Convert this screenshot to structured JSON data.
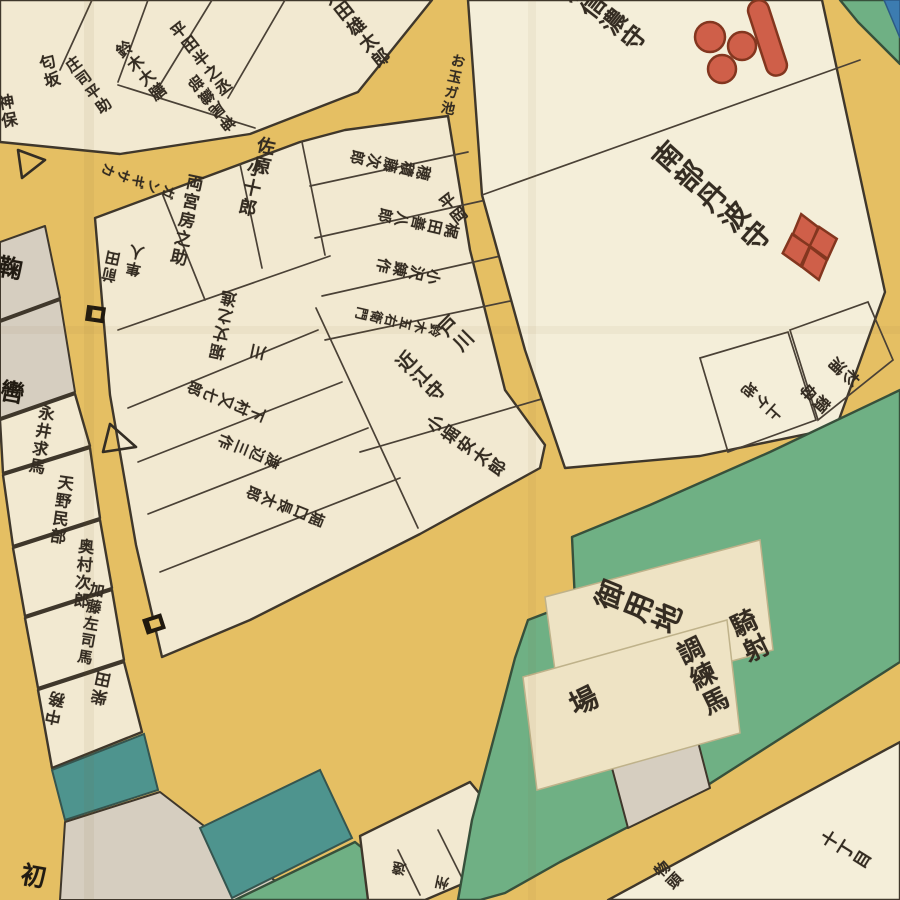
{
  "map": {
    "kind": "edo-kiriezu-woodblock-district-map-fragment",
    "training_ground_labels": [
      "騎射調練馬場",
      "御用地"
    ],
    "street_labels": [
      "ガンギサカ",
      "お玉ガ池",
      "十丁目"
    ]
  },
  "palette": {
    "road_yellow": "#e5bf63",
    "block_cream": "#f2e9d1",
    "ground_green": "#6fb084",
    "canal_teal": "#4e948e",
    "river_blue": "#3c7cb0",
    "plot_grey": "#d6cec0",
    "crest_red": "#cf5f49",
    "line_dark": "#3f372b",
    "ink_text": "#342c22"
  },
  "symbols": {
    "mori_crest": "ichimonji-mitsuboshi-crest (one red bar and three red circles)",
    "nanbu_crest": "waribishi-crest (four red diamonds)",
    "gate_icon": "black gate bracket (kido)",
    "watchpost_icon": "open triangle (tsujiban)"
  },
  "labels": [
    {
      "id": "plot-ota-yutaro",
      "text": "太田雄太郎",
      "x": 355,
      "y": 28,
      "rot": -38,
      "size": 18
    },
    {
      "id": "plot-hirata-hannojo",
      "text": "平田半之丞",
      "x": 200,
      "y": 60,
      "rot": -38,
      "size": 16
    },
    {
      "id": "plot-suzuki-daizen",
      "text": "鈴木大膳",
      "x": 140,
      "y": 72,
      "rot": -38,
      "size": 16
    },
    {
      "id": "plot-shoji-heisuke",
      "text": "庄司平助",
      "x": 88,
      "y": 86,
      "rot": -36,
      "size": 15
    },
    {
      "id": "plot-kanno-oribe",
      "text": "神尾織部",
      "x": 212,
      "y": 102,
      "rot": 142,
      "size": 15
    },
    {
      "id": "plot-sagisaka",
      "text": "匂坂",
      "x": 48,
      "y": 72,
      "rot": -15,
      "size": 16
    },
    {
      "id": "plot-jinbo",
      "text": "神保",
      "x": 6,
      "y": 112,
      "rot": -10,
      "size": 16
    },
    {
      "id": "glyph-upper-left",
      "text": "鞠",
      "x": 8,
      "y": 268,
      "rot": 10,
      "size": 24,
      "bold": true
    },
    {
      "id": "glyph-left",
      "text": "轡",
      "x": 10,
      "y": 392,
      "rot": 10,
      "size": 24,
      "bold": true
    },
    {
      "id": "plot-nagai",
      "text": "永井求馬",
      "x": 40,
      "y": 440,
      "rot": 10,
      "size": 16
    },
    {
      "id": "plot-amano",
      "text": "天野民部",
      "x": 60,
      "y": 510,
      "rot": 8,
      "size": 16
    },
    {
      "id": "plot-okumura",
      "text": "奥村次郎",
      "x": 82,
      "y": 574,
      "rot": 5,
      "size": 16
    },
    {
      "id": "plot-kato",
      "text": "加藤左司馬",
      "x": 90,
      "y": 624,
      "rot": 10,
      "size": 15
    },
    {
      "id": "plot-shibata-1",
      "text": "柴田",
      "x": 103,
      "y": 688,
      "rot": 192,
      "size": 16
    },
    {
      "id": "plot-shibata-2",
      "text": "中務",
      "x": 57,
      "y": 708,
      "rot": 192,
      "size": 16
    },
    {
      "id": "glyph-lower-left",
      "text": "初",
      "x": 32,
      "y": 876,
      "rot": 10,
      "size": 25,
      "bold": true
    },
    {
      "id": "street-gangizaka",
      "text": "ガンギサカ",
      "x": 138,
      "y": 180,
      "rot": 110,
      "size": 14
    },
    {
      "id": "plot-sahara-1",
      "text": "佐原",
      "x": 262,
      "y": 156,
      "rot": 12,
      "size": 18
    },
    {
      "id": "plot-sahara-2",
      "text": "小十郎",
      "x": 250,
      "y": 188,
      "rot": 12,
      "size": 18
    },
    {
      "id": "plot-ryogu",
      "text": "両宮房之助",
      "x": 184,
      "y": 220,
      "rot": 12,
      "size": 17
    },
    {
      "id": "plot-maeda-1",
      "text": "前田",
      "x": 112,
      "y": 266,
      "rot": 192,
      "size": 15
    },
    {
      "id": "plot-maeda-2",
      "text": "隼人",
      "x": 136,
      "y": 260,
      "rot": 192,
      "size": 15
    },
    {
      "id": "plot-hozumi",
      "text": "穂積藤次郎",
      "x": 390,
      "y": 164,
      "rot": 103,
      "size": 15
    },
    {
      "id": "plot-kajita",
      "text": "梶田善八郎",
      "x": 418,
      "y": 222,
      "rot": 103,
      "size": 15
    },
    {
      "id": "plot-ozawa",
      "text": "小沢錬作",
      "x": 408,
      "y": 270,
      "rot": 103,
      "size": 15
    },
    {
      "id": "plot-suzuki-goemon",
      "text": "鈴木五右衛門",
      "x": 398,
      "y": 320,
      "rot": 103,
      "size": 13
    },
    {
      "id": "plot-hiraoka",
      "text": "平岡",
      "x": 452,
      "y": 210,
      "rot": -38,
      "size": 16
    },
    {
      "id": "plot-hori-jonoshin",
      "text": "堀丈之進",
      "x": 225,
      "y": 325,
      "rot": 192,
      "size": 16
    },
    {
      "id": "plot-kawa",
      "text": "川",
      "x": 260,
      "y": 352,
      "rot": 192,
      "size": 16
    },
    {
      "id": "plot-shimomura",
      "text": "下村又七郎",
      "x": 226,
      "y": 400,
      "rot": 112,
      "size": 15
    },
    {
      "id": "plot-watanabe",
      "text": "渡辺三作",
      "x": 249,
      "y": 450,
      "rot": 112,
      "size": 15
    },
    {
      "id": "plot-horiguchi",
      "text": "堀口長太郎",
      "x": 285,
      "y": 505,
      "rot": 112,
      "size": 15
    },
    {
      "id": "plot-togawa-1",
      "text": "戸川",
      "x": 455,
      "y": 335,
      "rot": -45,
      "size": 19
    },
    {
      "id": "plot-togawa-2",
      "text": "近江守",
      "x": 420,
      "y": 378,
      "rot": -45,
      "size": 19
    },
    {
      "id": "plot-kobori",
      "text": "小堀安太郎",
      "x": 465,
      "y": 448,
      "rot": -55,
      "size": 17
    },
    {
      "id": "plot-mori",
      "text": "毛利信濃守",
      "x": 592,
      "y": 8,
      "rot": -52,
      "size": 24
    },
    {
      "id": "plot-nanbu",
      "text": "南部丹波守",
      "x": 711,
      "y": 198,
      "rot": -48,
      "size": 28
    },
    {
      "id": "plot-sugiura-1",
      "text": "杉浦",
      "x": 845,
      "y": 370,
      "rot": 132,
      "size": 16
    },
    {
      "id": "plot-sugiura-2",
      "text": "頼母",
      "x": 816,
      "y": 396,
      "rot": 132,
      "size": 16
    },
    {
      "id": "plot-agechi",
      "text": "上ケ地",
      "x": 762,
      "y": 400,
      "rot": 132,
      "size": 15
    },
    {
      "id": "ground-goyochi",
      "text": "御用地",
      "x": 638,
      "y": 609,
      "rot": -68,
      "size": 29
    },
    {
      "id": "ground-kisha-1",
      "text": "騎射",
      "x": 748,
      "y": 637,
      "rot": -26,
      "size": 26
    },
    {
      "id": "ground-kisha-2",
      "text": "調練馬",
      "x": 701,
      "y": 677,
      "rot": -26,
      "size": 26
    },
    {
      "id": "ground-kisha-3",
      "text": "場",
      "x": 582,
      "y": 702,
      "rot": -26,
      "size": 28
    },
    {
      "id": "street-otama",
      "text": "お玉ガ池",
      "x": 452,
      "y": 85,
      "rot": 12,
      "size": 14
    },
    {
      "id": "street-jucchome",
      "text": "十丁目",
      "x": 845,
      "y": 852,
      "rot": -58,
      "size": 17
    },
    {
      "id": "plot-monogashira",
      "text": "物頭",
      "x": 668,
      "y": 876,
      "rot": -45,
      "size": 15
    },
    {
      "id": "plot-bottom-1",
      "text": "遠",
      "x": 400,
      "y": 868,
      "rot": 192,
      "size": 14
    },
    {
      "id": "plot-bottom-2",
      "text": "州",
      "x": 443,
      "y": 882,
      "rot": 192,
      "size": 14
    }
  ]
}
